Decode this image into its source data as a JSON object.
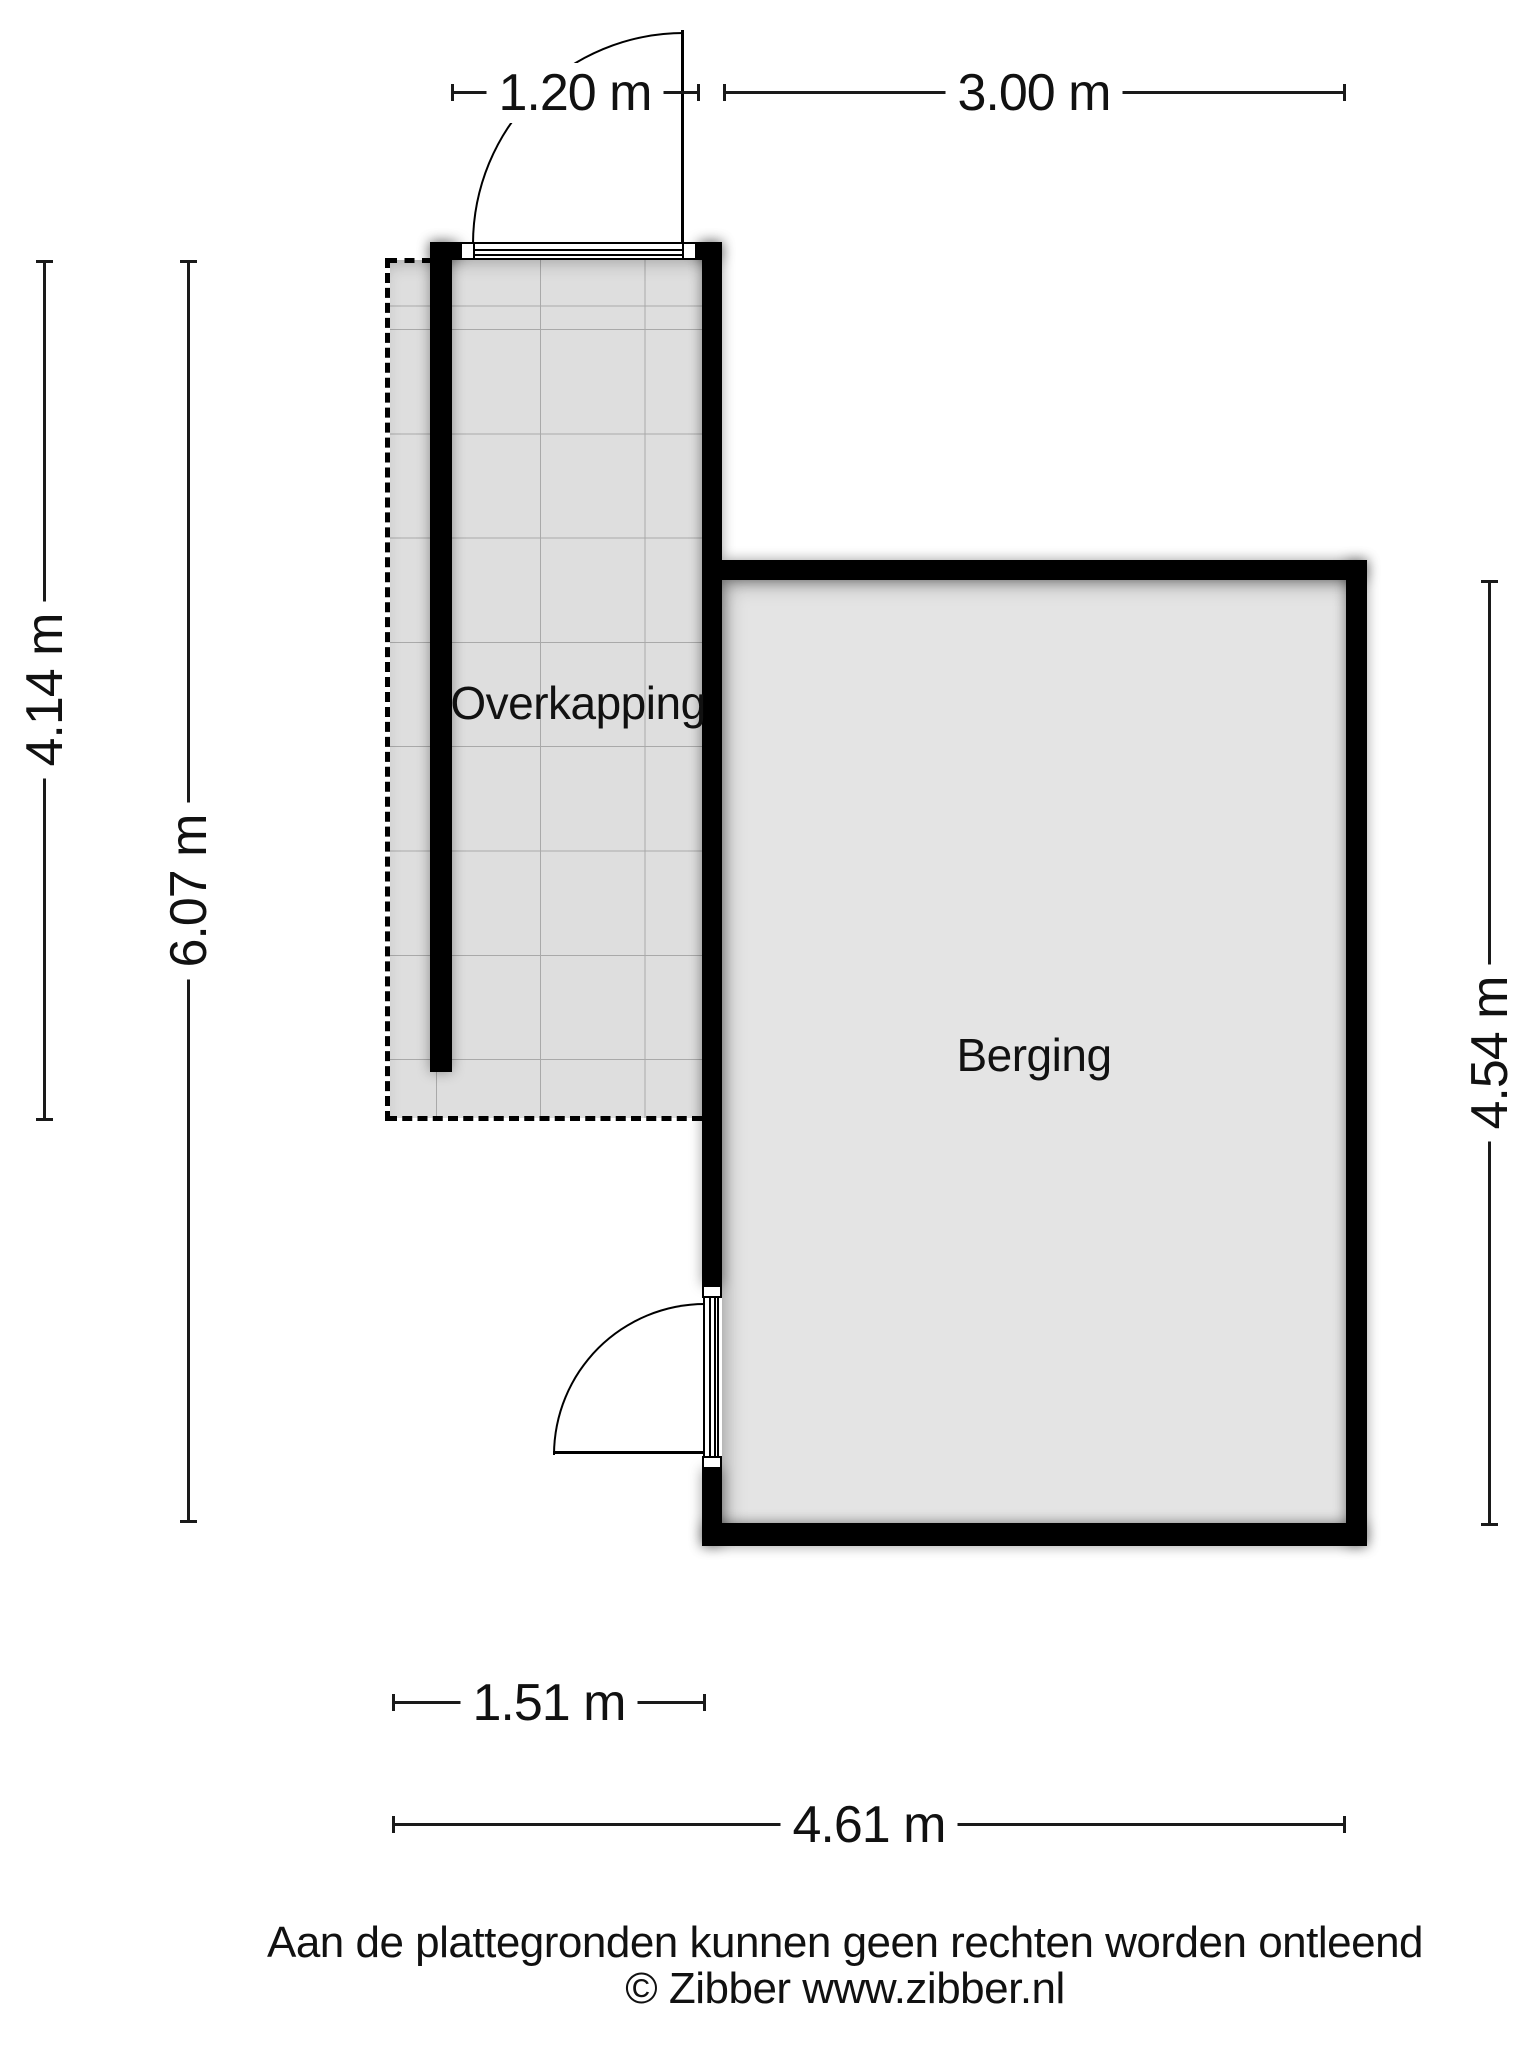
{
  "rooms": {
    "overkapping": {
      "label": "Overkapping"
    },
    "berging": {
      "label": "Berging"
    }
  },
  "dimensions": {
    "top": [
      {
        "label": "1.20 m"
      },
      {
        "label": "3.00 m"
      }
    ],
    "left": [
      {
        "label": "4.14 m"
      },
      {
        "label": "6.07 m"
      }
    ],
    "right": [
      {
        "label": "4.54 m"
      }
    ],
    "bottom": [
      {
        "label": "1.51 m"
      },
      {
        "label": "4.61 m"
      }
    ]
  },
  "footer": {
    "disclaimer": "Aan de plattegronden kunnen geen rechten worden ontleend",
    "copyright": "© Zibber www.zibber.nl"
  },
  "colors": {
    "wall": "#000000",
    "overkapping_fill": "#dedede",
    "berging_fill": "#e4e4e4",
    "tile_grid_line": "#a9a9a9",
    "dimension_line": "#1a1a1a",
    "background": "#ffffff"
  }
}
